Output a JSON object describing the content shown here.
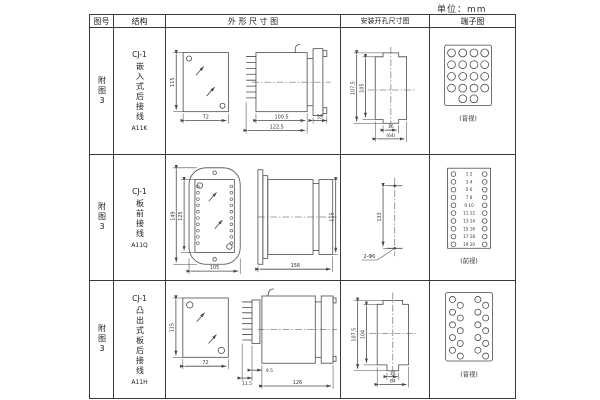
{
  "unit_label": "单位：mm",
  "header": {
    "fig": "图号",
    "structure": "结构",
    "outline": "外 形 尺 寸 图",
    "mounting": "安装开孔尺寸图",
    "terminal": "端子图"
  },
  "rows": [
    {
      "fig": "附图3",
      "model": "CJ-1",
      "wiring": "嵌入式后接线",
      "code": "A11K",
      "outline": {
        "height": "115",
        "width": "72",
        "body_len": "100.5",
        "total_len": "122.5",
        "flange": "35"
      },
      "mounting": {
        "outer_h": "107.5",
        "inner_h": "105",
        "slot_w": "16",
        "overall_w": "(64)"
      },
      "terminal_label": "(背视)"
    },
    {
      "fig": "附图3",
      "model": "CJ-1",
      "wiring": "板前接线",
      "code": "A11Q",
      "outline": {
        "outer_h": "149",
        "inner_h": "125",
        "width": "105",
        "side_len": "156",
        "side_h": "115"
      },
      "mounting": {
        "hole_dist": "133",
        "hole_label": "2-Φ6"
      },
      "terminal_label": "(前视)",
      "terminal_pairs": [
        "1 2",
        "3 4",
        "5 6",
        "7 8",
        "9 10",
        "11 12",
        "13 14",
        "15 16",
        "17 18",
        "19 20"
      ]
    },
    {
      "fig": "附图3",
      "model": "CJ-1",
      "wiring": "凸出式板后接线",
      "code": "A11H",
      "outline": {
        "height": "115",
        "width": "72",
        "stub": "11.5",
        "offset": "9.5",
        "body_len": "126"
      },
      "mounting": {
        "outer_h": "107.5",
        "inner_h": "104",
        "slot_w": "16",
        "overall_w": "64"
      },
      "terminal_label": "(背视)"
    }
  ]
}
